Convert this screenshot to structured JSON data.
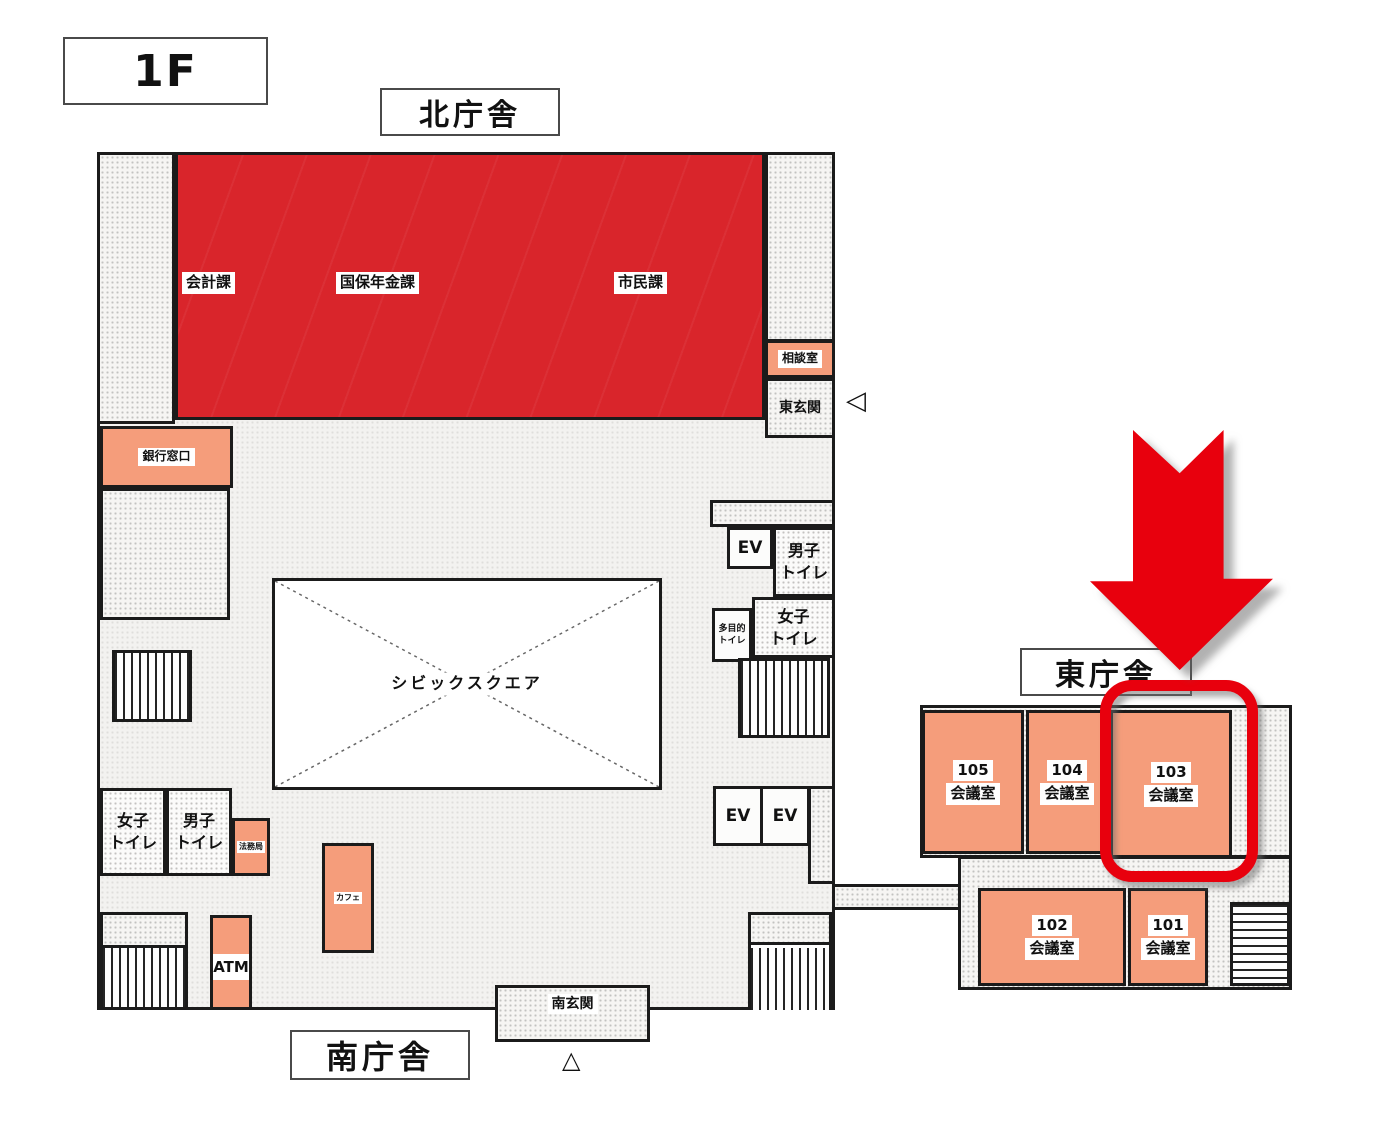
{
  "floor_label": "1F",
  "buildings": {
    "north": "北庁舎",
    "south": "南庁舎",
    "east": "東庁舎"
  },
  "north_wing": {
    "accounting": "会計課",
    "national_insurance_pension": "国保年金課",
    "citizen_affairs": "市民課",
    "consultation_room": "相談室",
    "east_entrance": "東玄関",
    "bank_counter": "銀行窓口"
  },
  "central": {
    "civic_square": "シビックスクエア",
    "elevator": "EV",
    "mens_toilet": [
      "男子",
      "トイレ"
    ],
    "womens_toilet": [
      "女子",
      "トイレ"
    ],
    "multipurpose_toilet": [
      "多目的",
      "トイレ"
    ],
    "legal_affairs": "法務局",
    "cafe": "カフェ",
    "atm": "ATM",
    "south_entrance": "南玄関"
  },
  "east_wing": {
    "rooms": [
      {
        "number": "105",
        "type": "会議室"
      },
      {
        "number": "104",
        "type": "会議室"
      },
      {
        "number": "103",
        "type": "会議室"
      },
      {
        "number": "102",
        "type": "会議室"
      },
      {
        "number": "101",
        "type": "会議室"
      }
    ],
    "highlighted_room": "103"
  },
  "markers": {
    "east_entrance_arrow": "◁",
    "south_entrance_arrow": "△"
  },
  "colors": {
    "department_red": "#d9252b",
    "room_orange": "#f59d7b",
    "highlight_red": "#e8000d"
  }
}
